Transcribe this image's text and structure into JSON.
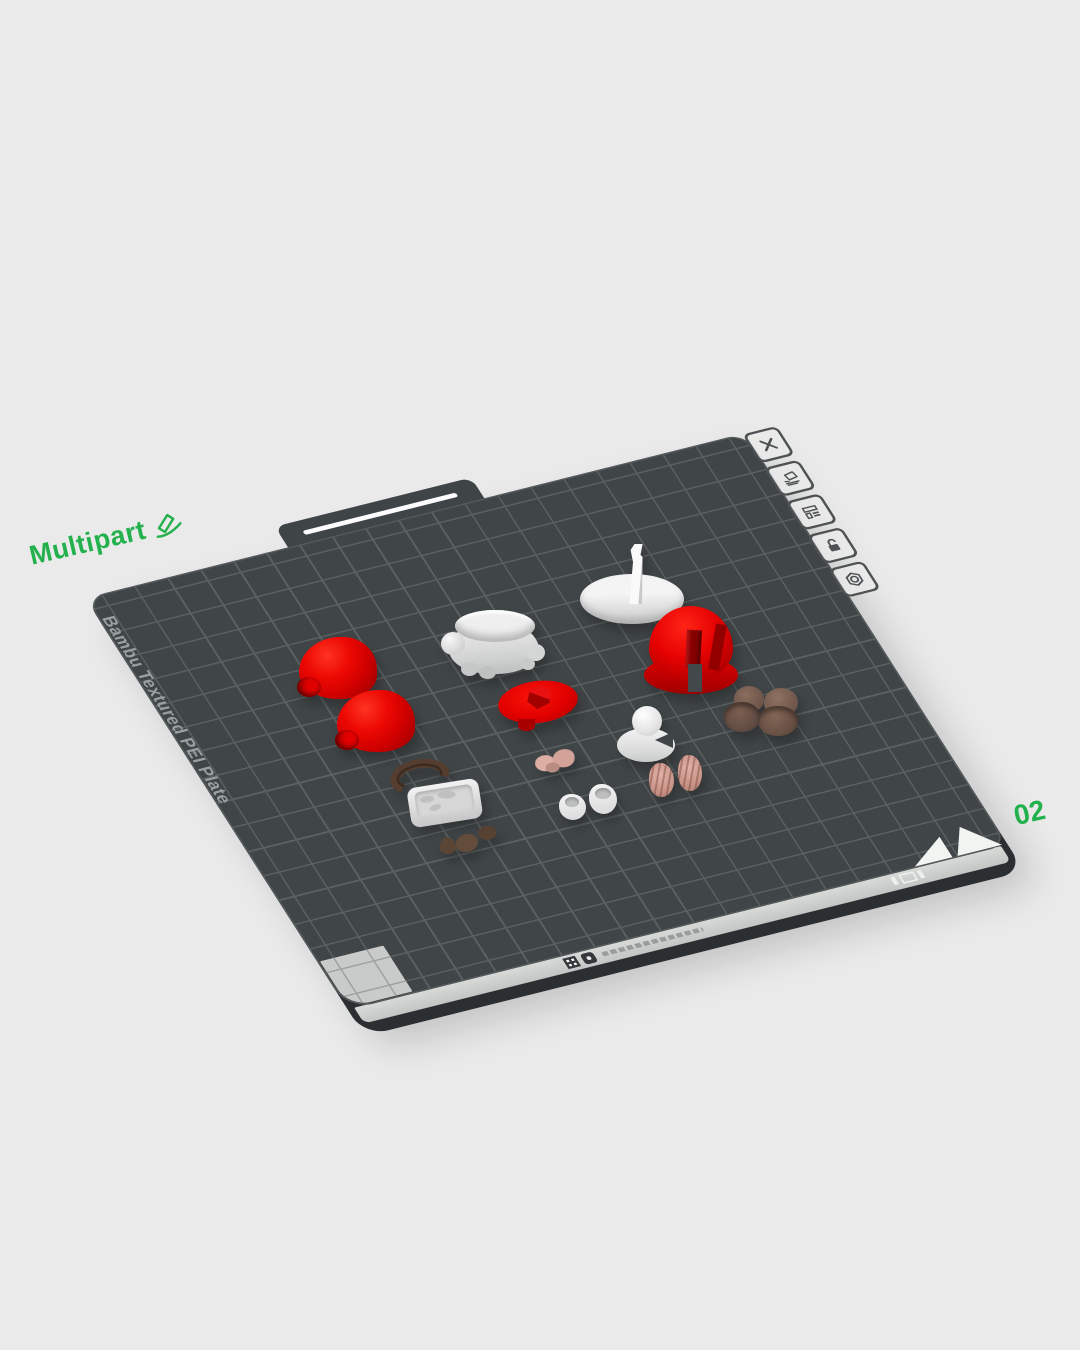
{
  "canvas": {
    "width": 1080,
    "height": 1350,
    "background_color": "#e9eae9"
  },
  "plate": {
    "name_label": "Multipart",
    "number_label": "02",
    "surface_label": "Bambu Textured PEI Plate",
    "accent_color": "#23b14d",
    "surface_color": "#404547",
    "grid_color": "#5b6061",
    "corner_marker_color": "#c8cbca",
    "front_edge_color": "#cfd2d0",
    "edge_shadow_color": "#2c2f31"
  },
  "plate_toolbar": {
    "buttons": [
      {
        "icon": "close-icon"
      },
      {
        "icon": "clean-plate-icon"
      },
      {
        "icon": "plate-settings-icon"
      },
      {
        "icon": "lock-open-icon"
      },
      {
        "icon": "gear-icon"
      }
    ]
  },
  "models": [
    {
      "name": "red-glove-left",
      "color": "#e60000"
    },
    {
      "name": "red-glove-right",
      "color": "#e60000"
    },
    {
      "name": "white-torso",
      "color": "#dedede"
    },
    {
      "name": "red-cap-brim",
      "color": "#e10000"
    },
    {
      "name": "white-base-with-fin",
      "color": "#ececec"
    },
    {
      "name": "red-cap-dome",
      "color": "#dd0000"
    },
    {
      "name": "brown-shoes",
      "color": "#6e564a"
    },
    {
      "name": "brown-belt",
      "color": "#4f3a2d"
    },
    {
      "name": "white-tray",
      "color": "#e3e3e3"
    },
    {
      "name": "brown-mustache-pieces",
      "color": "#5e4739"
    },
    {
      "name": "pink-ears",
      "color": "#d9aba1"
    },
    {
      "name": "white-head",
      "color": "#ececec"
    },
    {
      "name": "pink-fists",
      "color": "#d4a096"
    },
    {
      "name": "white-boots",
      "color": "#ececec"
    }
  ]
}
